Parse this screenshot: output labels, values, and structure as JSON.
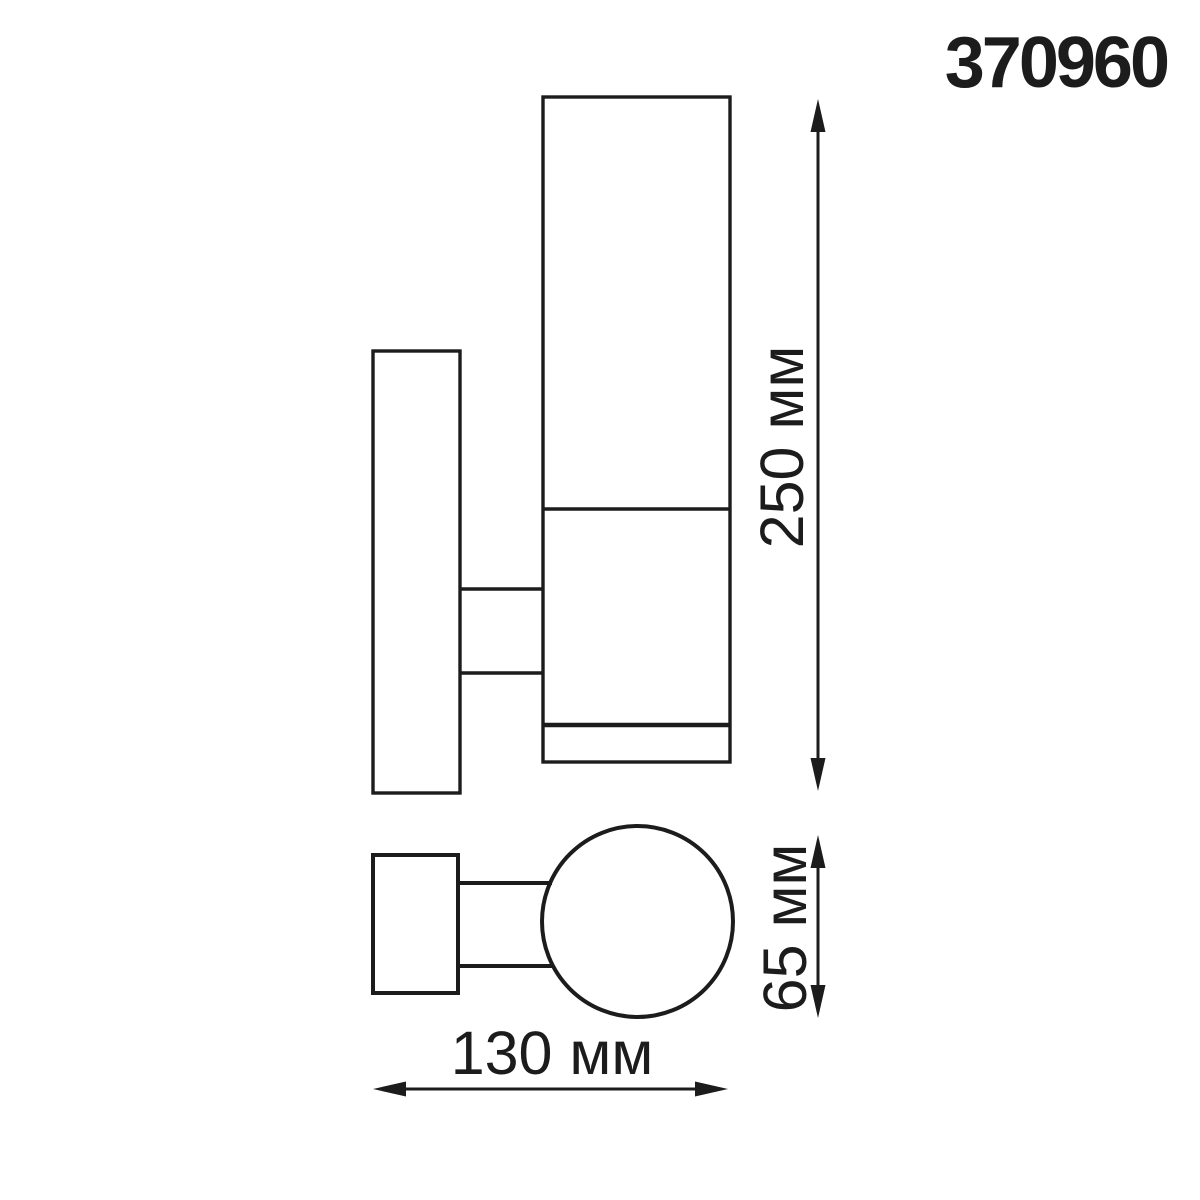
{
  "product_code": "370960",
  "dimensions": {
    "height": "250 мм",
    "diameter": "65 мм",
    "depth": "130 мм"
  },
  "colors": {
    "line": "#1c1c1c",
    "background": "#ffffff"
  }
}
